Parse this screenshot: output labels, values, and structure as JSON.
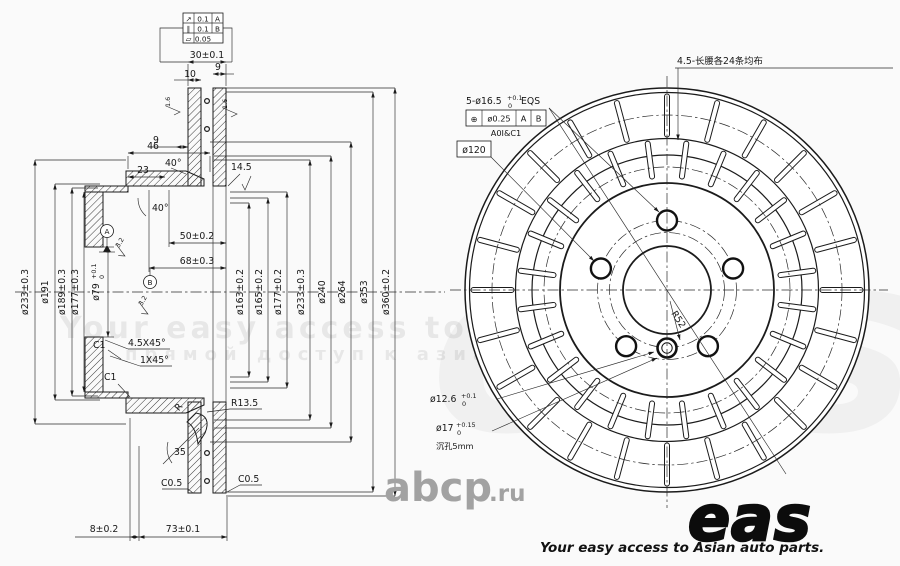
{
  "watermark": {
    "headline": "Your easy access to Asian auto parts",
    "subline": "прямой доступ к азиатским запчастям",
    "ghost": "eas",
    "site_name": "abcp",
    "site_tld": ".ru"
  },
  "logo": {
    "name": "eas",
    "tagline": "Your easy access to Asian auto parts."
  },
  "tolerance_frame": {
    "rows": [
      {
        "symbol": "↗",
        "value": "0.1",
        "datum": "A"
      },
      {
        "symbol": "∥",
        "value": "0.1",
        "datum": "B"
      },
      {
        "symbol": "▱",
        "value": "0.05",
        "datum": ""
      }
    ]
  },
  "section": {
    "overall_thickness": "30±0.1",
    "outer_plate": "10",
    "inner_plate": "9",
    "vane": "9",
    "hat_height": "46",
    "hat_offset": "23",
    "angle_flange": "40°",
    "angle_cone": "40°",
    "pad_depth": "14.5",
    "depth_50": "50±0.2",
    "depth_68": "68±0.3",
    "dia_233_left": "ø233±0.3",
    "dia_191": "ø191",
    "dia_189": "ø189±0.3",
    "dia_177_left": "ø177±0.3",
    "bore": "ø79",
    "bore_sup": "+0.1",
    "bore_sub": "0",
    "dia_163": "ø163±0.2",
    "dia_165": "ø165±0.2",
    "dia_177_right": "ø177±0.2",
    "dia_233_right": "ø233±0.3",
    "dia_240": "ø240",
    "dia_264": "ø264",
    "dia_353": "ø353",
    "dia_360": "ø360±0.2",
    "chamfer_c1_upper": "C1",
    "chamfer_45": "4.5X45°",
    "chamfer_1x45": "1X45°",
    "chamfer_c1_lower": "C1",
    "radius_r": "R",
    "radius_r135": "R13.5",
    "angle_35": "35",
    "chamfer_c05_left": "C0.5",
    "chamfer_c05_right": "C0.5",
    "base_8": "8±0.2",
    "base_73": "73±0.1",
    "datum_a": "A",
    "datum_b": "B",
    "roughness_16_left": "1.6",
    "roughness_16_right": "1.6",
    "roughness_32_upper": "3.2",
    "roughness_32_lower": "3.2"
  },
  "front": {
    "slots_note": "4.5-长腰各24条均布",
    "holes_note": "5-ø16.5",
    "holes_sup": "+0.1",
    "holes_sub": "0",
    "holes_suffix": "EQS",
    "position_symbol": "⊕",
    "position_tolerance": "ø0.25",
    "position_datum_a": "A",
    "position_datum_b": "B",
    "chamfer_note": "A0I&C1",
    "bolt_circle": "ø120",
    "pin_hole": "ø12.6",
    "pin_sup": "+0.1",
    "pin_sub": "0",
    "counterbore": "ø17",
    "counterbore_sup": "+0.15",
    "counterbore_sub": "0",
    "depth_note": "沉孔5mm",
    "radius_52": "R52"
  }
}
